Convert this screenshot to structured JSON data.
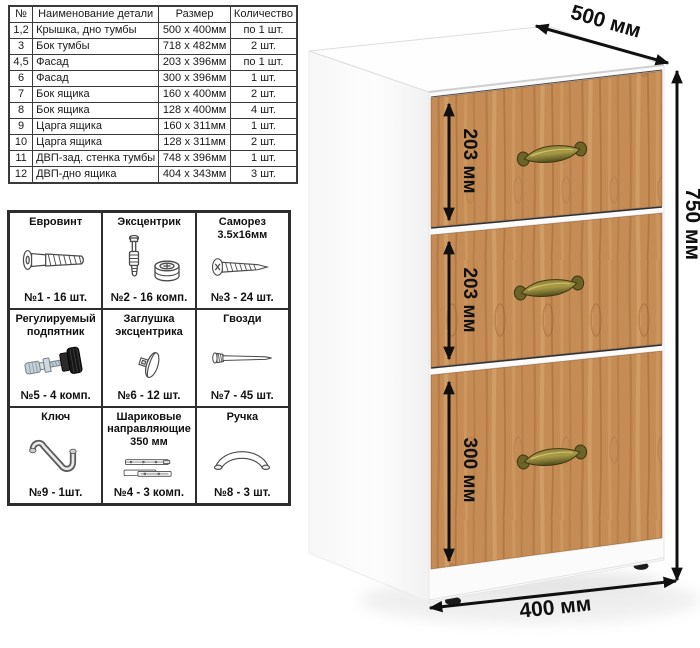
{
  "parts_table": {
    "headers": [
      "№",
      "Наименование детали",
      "Размер",
      "Количество"
    ],
    "rows": [
      [
        "1,2",
        "Крышка, дно тумбы",
        "500 x 400мм",
        "по 1 шт."
      ],
      [
        "3",
        "Бок тумбы",
        "718 x 482мм",
        "2 шт."
      ],
      [
        "4,5",
        "Фасад",
        "203 x 396мм",
        "по 1 шт."
      ],
      [
        "6",
        "Фасад",
        "300 x 396мм",
        "1 шт."
      ],
      [
        "7",
        "Бок ящика",
        "160 x 400мм",
        "2 шт."
      ],
      [
        "8",
        "Бок ящика",
        "128 x 400мм",
        "4 шт."
      ],
      [
        "9",
        "Царга ящика",
        "160 x 311мм",
        "1 шт."
      ],
      [
        "10",
        "Царга ящика",
        "128 x 311мм",
        "2 шт."
      ],
      [
        "11",
        "ДВП-зад. стенка тумбы",
        "748 x 396мм",
        "1 шт."
      ],
      [
        "12",
        "ДВП-дно ящика",
        "404 x 343мм",
        "3 шт."
      ]
    ]
  },
  "hardware": {
    "items": [
      {
        "title": "Евровинт",
        "icon": "euro-screw-icon",
        "qty": "№1 - 16 шт."
      },
      {
        "title": "Эксцентрик",
        "icon": "cam-lock-icon",
        "qty": "№2 - 16 комп."
      },
      {
        "title": "Саморез 3.5x16мм",
        "icon": "self-tapping-screw-icon",
        "qty": "№3 - 24 шт."
      },
      {
        "title": "Регулируемый подпятник",
        "icon": "adjustable-foot-icon",
        "qty": "№5 - 4 комп."
      },
      {
        "title": "Заглушка эксцентрика",
        "icon": "cam-cover-icon",
        "qty": "№6 - 12 шт."
      },
      {
        "title": "Гвозди",
        "icon": "nail-icon",
        "qty": "№7 - 45 шт."
      },
      {
        "title": "Ключ",
        "icon": "hex-key-icon",
        "qty": "№9 - 1шт."
      },
      {
        "title": "Шариковые направляющие 350 мм",
        "icon": "ball-slides-icon",
        "qty": "№4 - 3 комп."
      },
      {
        "title": "Ручка",
        "icon": "handle-icon",
        "qty": "№8 - 3 шт."
      }
    ]
  },
  "cabinet": {
    "depth_label": "500 мм",
    "height_label": "750 мм",
    "width_label": "400 мм",
    "drawer_labels": [
      "203 мм",
      "203 мм",
      "300 мм"
    ],
    "colors": {
      "body": "#ffffff",
      "drawer_wood": "#c68c55",
      "handle_brass": "#8a7d33",
      "dimension_arrow": "#101010"
    }
  }
}
